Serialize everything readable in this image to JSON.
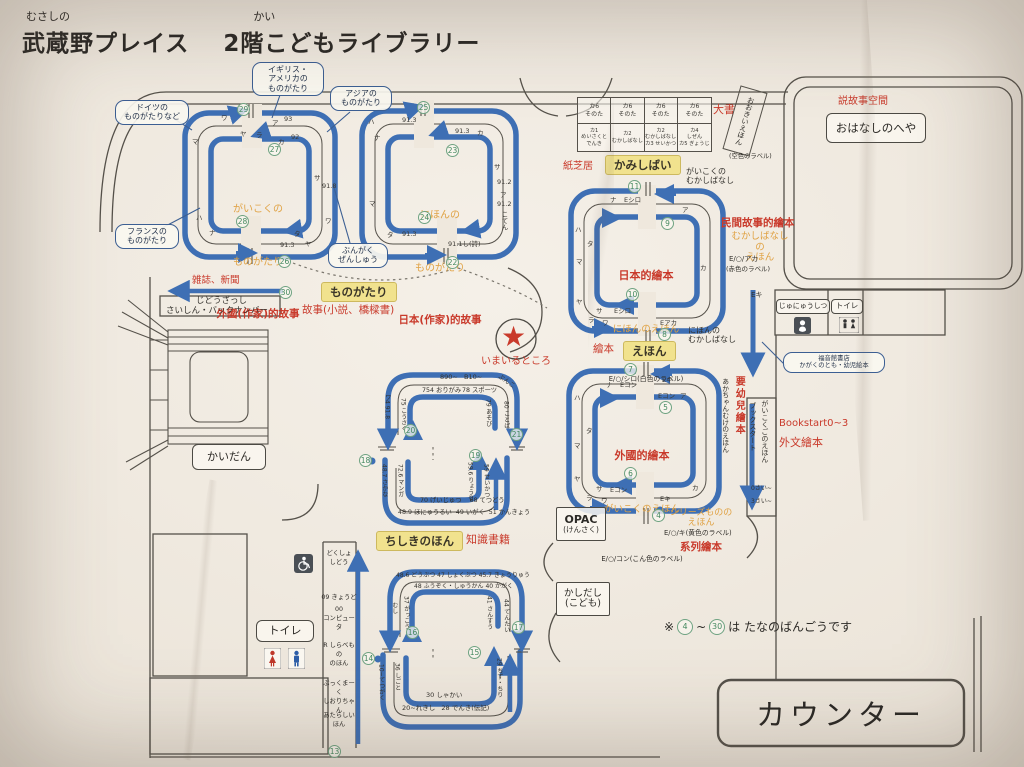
{
  "title": {
    "furigana_place": "むさしの",
    "place": "武蔵野プレイス",
    "furigana_floor": "かい",
    "floor": "2階こどもライブラリー"
  },
  "callouts": {
    "germany": "ドイツの\nものがたりなど",
    "uk_us": "イギリス・\nアメリカの\nものがたり",
    "asia": "アジアの\nものがたり",
    "france": "フランスの\nものがたり",
    "literature": "ぶんがく\nぜんしゅう",
    "fukuinkan": "福音館書店\nかがくのとも・幼児絵本"
  },
  "loop_foreign_story": {
    "kana1": "がいこくの",
    "kana2": "ものがたり",
    "cn": "外國(作家)的故事",
    "badges": [
      "29",
      "27",
      "28",
      "26"
    ],
    "marks": [
      "ワ",
      "ヤ",
      "ラ",
      "ア",
      "93",
      "カ",
      "92",
      "サ",
      "91.8",
      "ワ",
      "タ",
      "ヤ",
      "91.3",
      "ナ",
      "ハ",
      "マ"
    ]
  },
  "loop_japan_story": {
    "kana1": "にほんの",
    "kana2": "ものがたり",
    "cn": "日本(作家)的故事",
    "badges": [
      "25",
      "23",
      "24",
      "22"
    ],
    "marks": [
      "ハ",
      "ナ",
      "91.3",
      "91.3",
      "カ",
      "サ",
      "91.2",
      "ア",
      "91.2",
      "こてん",
      "マ",
      "タ",
      "91.3",
      "91.1し(詩)"
    ]
  },
  "magazines": {
    "cn": "雑誌、新聞",
    "line1": "じどうざっし",
    "line2": "さいしん・バックナンバー",
    "badge": "30"
  },
  "story_section": {
    "label": "ものがたり",
    "cn": "故事(小説、橋樑書)"
  },
  "you_are_here": {
    "star": "★",
    "label": "いまいるところ"
  },
  "stairs": {
    "label": "かいだん"
  },
  "kamishibai": {
    "cn": "紙芝居",
    "label": "かみしばい",
    "row1": [
      "カ6\nそのた",
      "カ6\nそのた",
      "カ6\nそのた",
      "カ6\nそのた"
    ],
    "row2": [
      "カ1\nめいさくと\nでんき",
      "カ2\nむかしばなし",
      "カ2\nむかしばなし\nカ3 せいかつ",
      "カ4\nしぜん\nカ5 ぎょうじ"
    ]
  },
  "big_books": {
    "cn": "大書",
    "label": "おおきいえほん",
    "note": "(空色のラベル)"
  },
  "story_room": {
    "cn": "説故事空間",
    "label": "おはなしのへや"
  },
  "loop_japan_picture": {
    "cn": "日本的繪本",
    "kana": "にほんのえほん",
    "call": "E/○/シロ(白色のラベル)",
    "badges": [
      "11",
      "9",
      "10",
      "8"
    ],
    "marks": [
      "ナ",
      "Eシロ",
      "ア",
      "カ",
      "ハ",
      "タ",
      "マ",
      "ヤ",
      "サ",
      "Eシロ",
      "ラ",
      "ワ",
      "Eアカ"
    ],
    "top_note": "がいこくの\nむかしばなし",
    "bottom_note": "にほんの\nむかしばなし"
  },
  "folk_tales": {
    "cn": "民間故事的繪本",
    "kana": "むかしばなしの\nえほん",
    "call": "E/○/アカ",
    "note": "(赤色のラベル)"
  },
  "picture_section": {
    "cn": "繪本",
    "label": "えほん"
  },
  "loop_foreign_picture": {
    "cn": "外國的繪本",
    "kana": "がいこくのえほん",
    "call": "E/○/コン(こん色のラベル)",
    "badges": [
      "7",
      "5",
      "6",
      "4"
    ],
    "marks": [
      "ナ",
      "Eコン",
      "Eキ",
      "Eコン",
      "ア",
      "カ",
      "ハ",
      "タ",
      "マ",
      "ヤ",
      "サ",
      "Eコン",
      "ラ",
      "ワ",
      "Eキ"
    ]
  },
  "series_books": {
    "badge": "4",
    "kana": "シリーズものの\nえほん",
    "call": "E/○/キ(黄色のラベル)",
    "cn": "系列繪本"
  },
  "baby_area": {
    "kana_vertical": "あかちゃんむけのえほん",
    "cn_vertical": "要幼兒繪本",
    "bookstart_vertical": "ブックスタート",
    "foreign_lang_vertical": "がいこくごのえほん",
    "age0": "0さい~",
    "age3": "3さい~",
    "bookstart": "Bookstart0~3",
    "foreign_cn": "外文繪本",
    "shelf_mark": "Eキ"
  },
  "facilities": {
    "nursing": "じゅにゅうしつ",
    "toilet_right": "トイレ",
    "toilet_left": "トイレ"
  },
  "knowledge_section": {
    "label": "ちしきのほん",
    "cn": "知識書籍"
  },
  "loop_hobby": {
    "top_outer": "890~   B10~",
    "top_corner": "ぶんこ",
    "top_inner_left": "754 おりがみ",
    "top_inner_right": "78 スポーツ",
    "left_outer": "ワ4 91.8",
    "left_inner": "75 こうさく",
    "right_inner": "79 あそび",
    "right_outer": "80 ことば",
    "badges": [
      "20",
      "21",
      "18",
      "19"
    ],
    "low_left_outer": "48.7 さかな",
    "low_left_inner": "72.6 マンガ",
    "low_bottom_inner": "70 げいじゅつ    68 てつどう",
    "low_bottom_outer": "48.9 ほにゅうるい  49 いがく  51 かんきょう",
    "low_right_inner": "59.6 りょうり",
    "low_right_outer": "59 せいかつ"
  },
  "loop_knowledge": {
    "top_outer": "48.6 どうぶつ 47 しょくぶつ 45.7 きょうりゅう",
    "top_inner": "48 ふうぞく・しゅうかん 40 かがく",
    "left_outer": "むし",
    "left_inner": "37 がっこう",
    "right_inner": "41 さんすう",
    "right_outer": "44 てんたい",
    "badges": [
      "16",
      "17",
      "14",
      "15"
    ],
    "low_left_outer": "10~てつがく",
    "low_left_inner": "36 しごと",
    "low_bottom_inner": "30 しゃかい",
    "low_bottom_outer": "20~れきし   28 でんき(伝記)",
    "low_right": "29 ちず・ちり"
  },
  "left_shelf_column": {
    "items": [
      "どくしょ\nしどう",
      "09 きょうど",
      "00\nコンピュータ",
      "R しらべもの\nのほん",
      "ぶっくまーく\nしおりちゃん",
      "あたらしい\nほん"
    ],
    "badge": "13"
  },
  "opac": {
    "line1": "OPAC",
    "line2": "(けんさく)"
  },
  "lending": {
    "line1": "かしだし",
    "line2": "(こども)"
  },
  "note": {
    "prefix": "※",
    "from": "4",
    "tilde": "~",
    "to": "30",
    "suffix": "は たなのばんごうです"
  },
  "counter": {
    "label": "カウンター"
  }
}
